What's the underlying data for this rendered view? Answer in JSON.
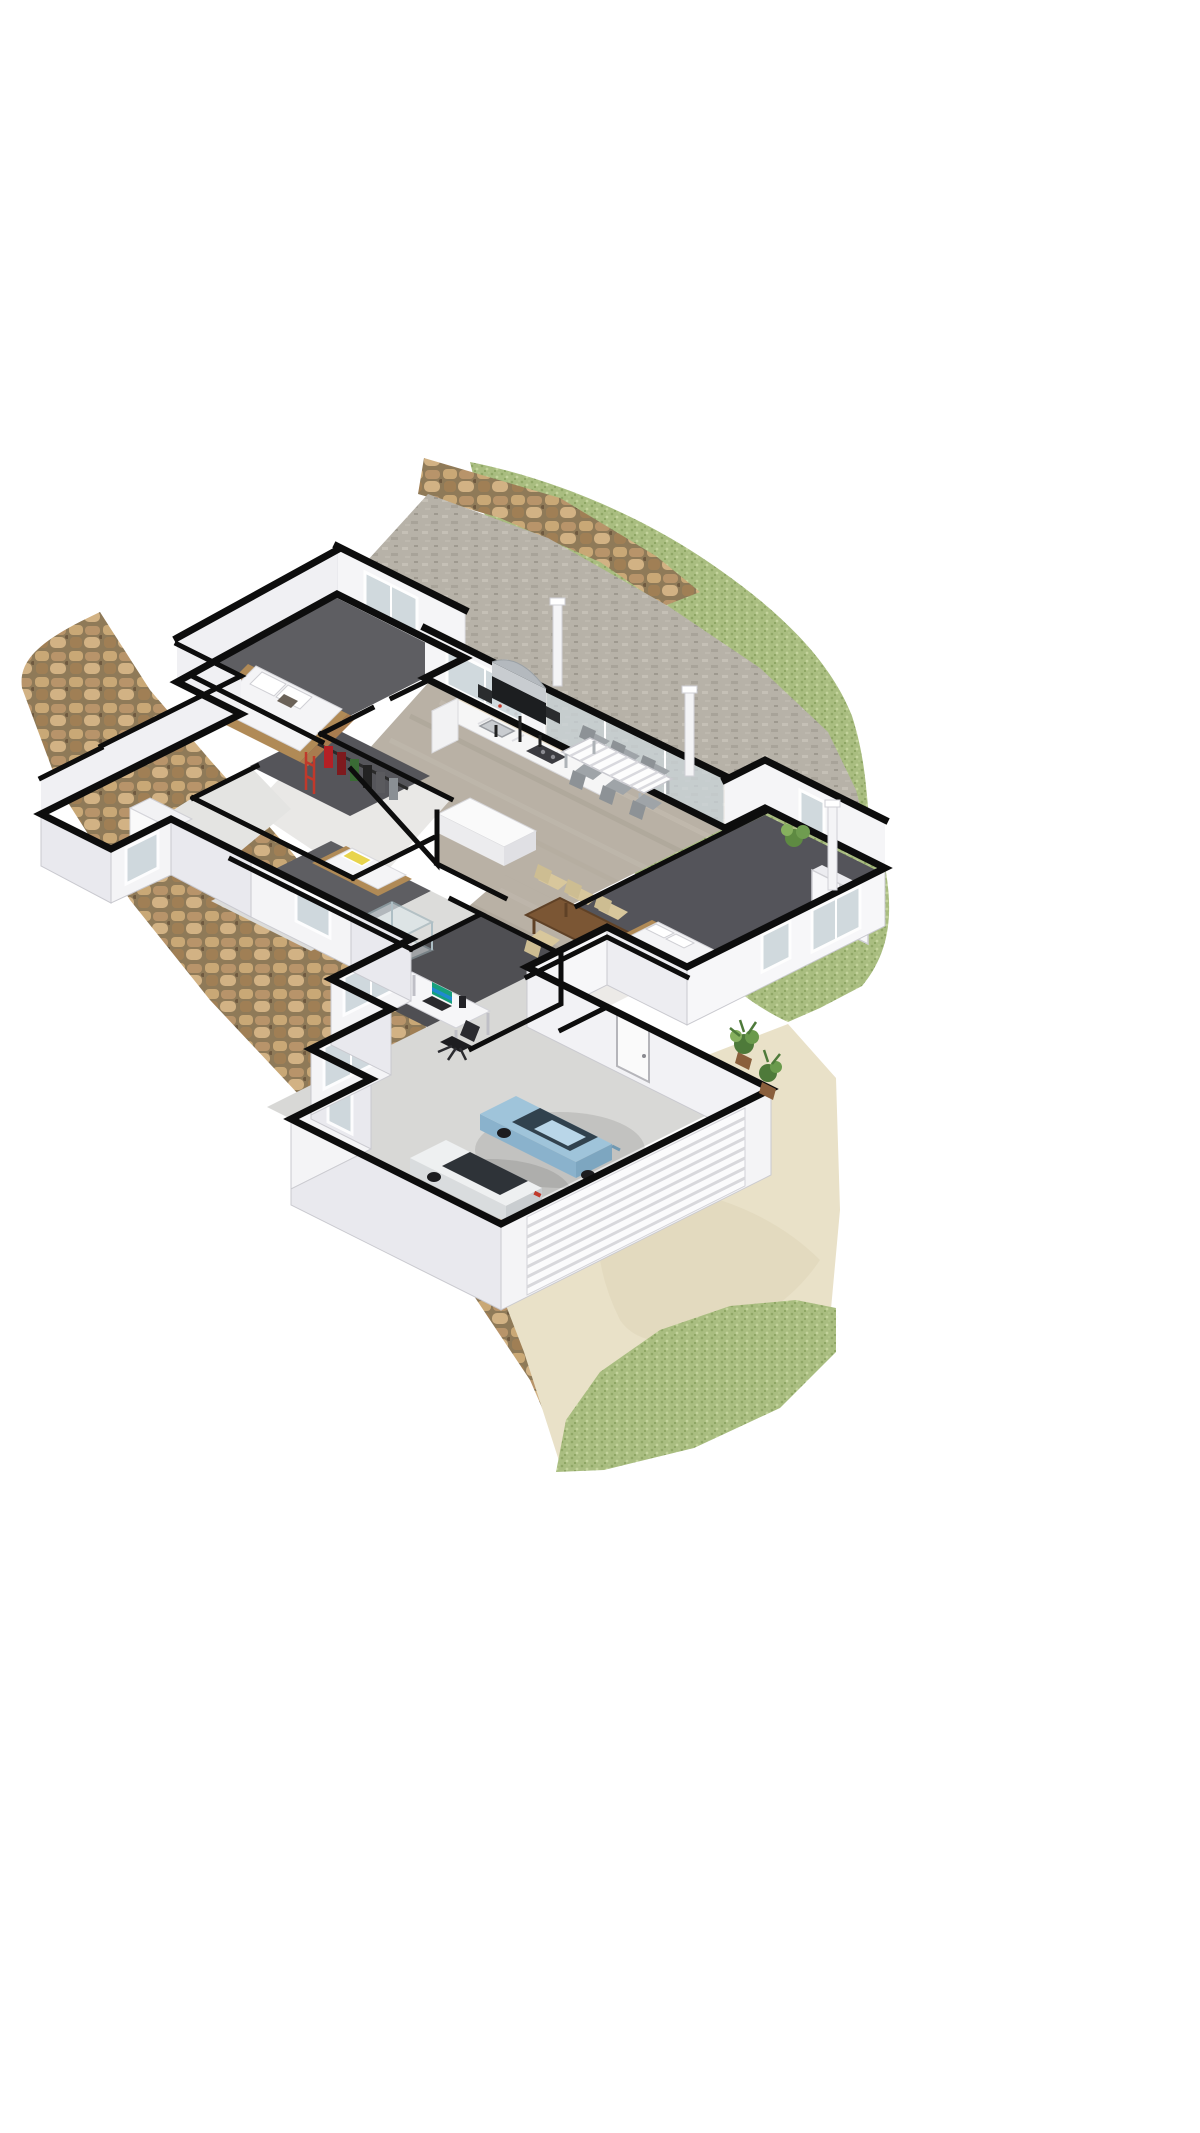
{
  "scene": {
    "type": "3d-floor-plan-render",
    "view": "isometric cutaway dollhouse, white background",
    "house": {
      "rooms": [
        {
          "name": "bedroom-1",
          "floor": "dark grey carpet",
          "furniture": [
            "timber double bed",
            "white bedding",
            "two pillows",
            "window"
          ]
        },
        {
          "name": "walk-in-closet",
          "floor": "dark grey carpet",
          "furniture": [
            "clothes rail",
            "hanging garments red green black"
          ]
        },
        {
          "name": "laundry",
          "floor": "light tile",
          "furniture": [
            "white washing machine",
            "window"
          ]
        },
        {
          "name": "bedroom-2",
          "floor": "dark grey carpet",
          "furniture": [
            "single bed",
            "yellow striped pillow",
            "windows"
          ]
        },
        {
          "name": "bathroom",
          "floor": "light tile",
          "furniture": [
            "vanity sink",
            "glass shower"
          ]
        },
        {
          "name": "home-office",
          "floor": "dark grey carpet",
          "furniture": [
            "white desk",
            "laptop with teal screen",
            "black office chair",
            "white shelf unit",
            "window"
          ]
        },
        {
          "name": "kitchen",
          "floor": "grey timber planks",
          "furniture": [
            "white L-shaped counter",
            "island bench",
            "cooktop",
            "sink"
          ]
        },
        {
          "name": "dining-living",
          "floor": "grey timber planks",
          "furniture": [
            "timber dining table",
            "six beige chairs",
            "sliding glass doors"
          ]
        },
        {
          "name": "master-bedroom",
          "floor": "dark grey carpet",
          "furniture": [
            "timber bed",
            "white double wardrobe",
            "windows"
          ]
        },
        {
          "name": "entry-porch",
          "floor": "light concrete",
          "furniture": [
            "front door",
            "potted plants"
          ]
        },
        {
          "name": "garage",
          "floor": "grey concrete",
          "furniture": [
            "light blue hatchback",
            "white car",
            "ribbed panel garage door"
          ]
        }
      ]
    },
    "exterior": {
      "lawn": "large mottled green lawn wrapping the top and right of the house",
      "patio": "grey paved terrace along the rear wall",
      "patio_furniture": [
        "black and silver BBQ grill",
        "white slatted outdoor table",
        "six grey outdoor chairs"
      ],
      "pergola_posts": 3,
      "stone_path": "brown cobblestone band along the lower-left walls",
      "driveway": "cream concrete driveway from garage to bottom right",
      "plants": [
        "corner shrub",
        "porch potted plants"
      ]
    },
    "colors": {
      "background": "#ffffff",
      "wall_line": "#0d0d0d",
      "wall_face": "#f7f7f9",
      "wall_face_shade": "#e9e9ee",
      "grass_base": "#a9bd80",
      "grass_dark": "#8fa766",
      "grass_light": "#c3d39b",
      "patio_base": "#b7b2a8",
      "cobble_base": "#8f7a58",
      "cobble_stone": "#c9a876",
      "driveway": "#e9e1c8",
      "carpet_dark": "#5e5e62",
      "great_floor": "#b9b1a5",
      "garage_floor": "#d8d8d6",
      "car_blue": "#9fc4da",
      "car_white": "#eef0f1",
      "table_wood": "#7b5634",
      "chair_beige": "#d8c79c",
      "outdoor_chair_grey": "#9fa4a8",
      "plant_green": "#5e8a42",
      "post_white": "#f4f4f6",
      "glass": "#ccd6db"
    }
  }
}
